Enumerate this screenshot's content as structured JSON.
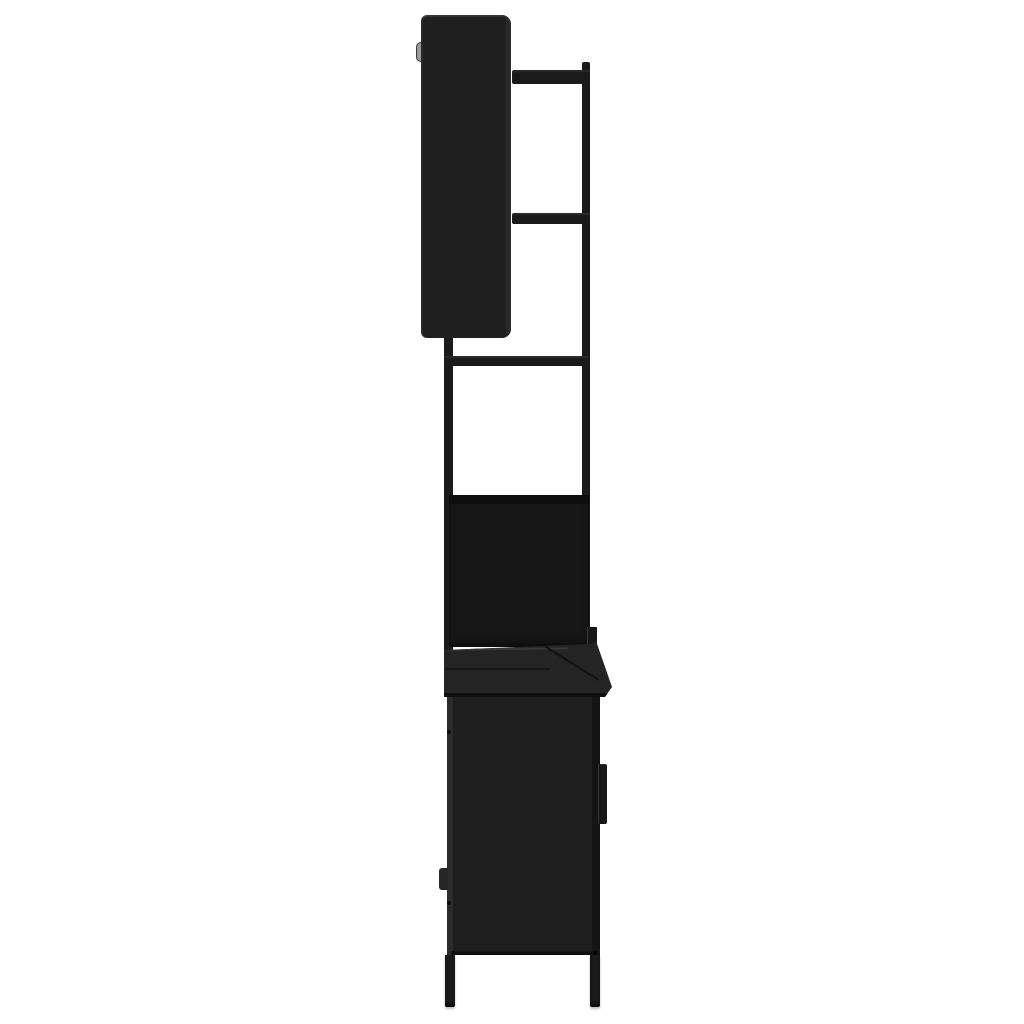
{
  "canvas": {
    "width": 1024,
    "height": 1024,
    "background": "#ffffff"
  },
  "palette": {
    "cabinet_face": "#1f1f1f",
    "cabinet_side_light": "#2b2b2b",
    "frame_black": "#1a1a1a",
    "panel_deep": "#171717",
    "shadow_line": "#0d0d0d",
    "counter_surface": "#242424",
    "edge_highlight": "#3a3a3a",
    "fold_line": "#151515",
    "seam_line": "#0c0c0c",
    "body_black": "#1e1e1e",
    "right_edge_dark": "#141414",
    "hinge_gray": "#262626",
    "handle_black": "#181818",
    "screw_black": "#000000",
    "bracket_gray": "#9a9a9a",
    "leg_black": "#1c1c1c"
  },
  "parts": {
    "mirror_cabinet": "wall-mounted mirror cabinet, side view",
    "mount_bracket": "gray wall-mount bracket clip",
    "frame": "black steel ladder frame with two cross bars",
    "tower": "open shelf tower with cross bar and back panel",
    "countertop": "base cabinet top slab with front overhang",
    "base_cabinet": "floor cabinet body with door handle and hinge",
    "legs": "two slim steel legs"
  }
}
